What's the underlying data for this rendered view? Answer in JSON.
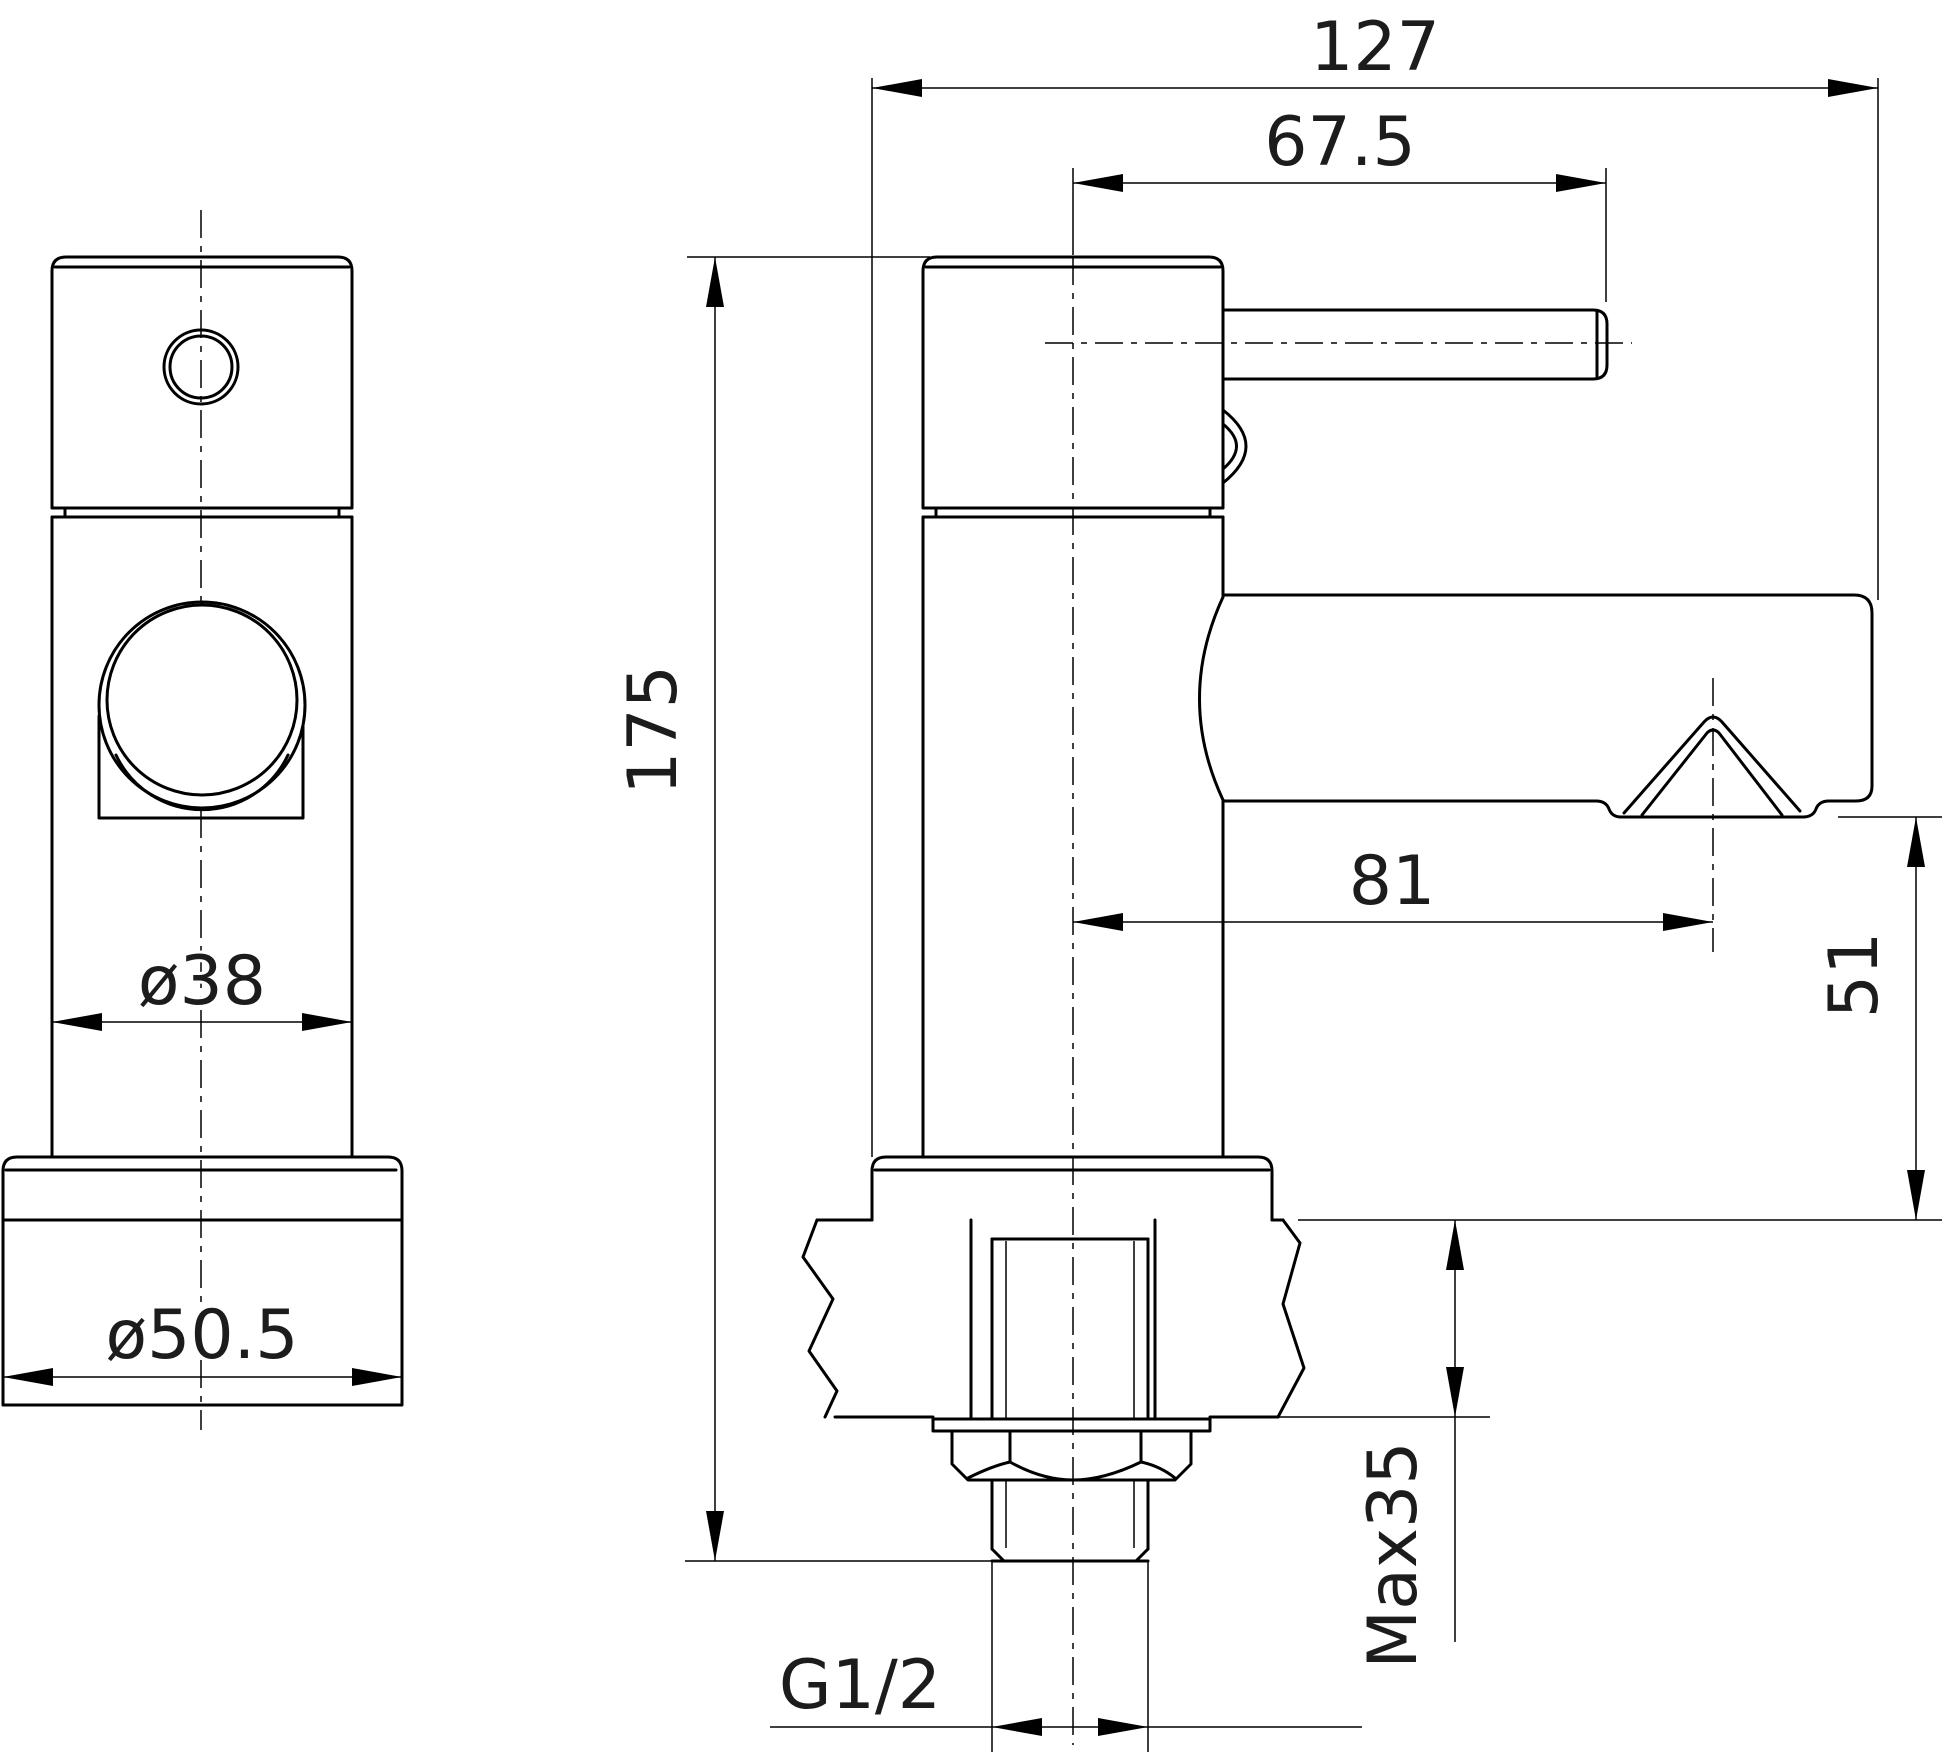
{
  "drawing": {
    "background": "#ffffff",
    "line_color": "#000000",
    "text_color": "#1c1c1c",
    "dims": {
      "overall_depth": {
        "label": "127"
      },
      "handle_reach": {
        "label": "67.5"
      },
      "overall_height": {
        "label": "175"
      },
      "spout_reach": {
        "label": "81"
      },
      "spout_height": {
        "label": "51"
      },
      "max_deck_thickness": {
        "label": "Max35"
      },
      "inlet_thread": {
        "label": "G1/2"
      },
      "body_diameter": {
        "label": "ø38"
      },
      "base_diameter": {
        "label": "ø50.5"
      }
    }
  }
}
